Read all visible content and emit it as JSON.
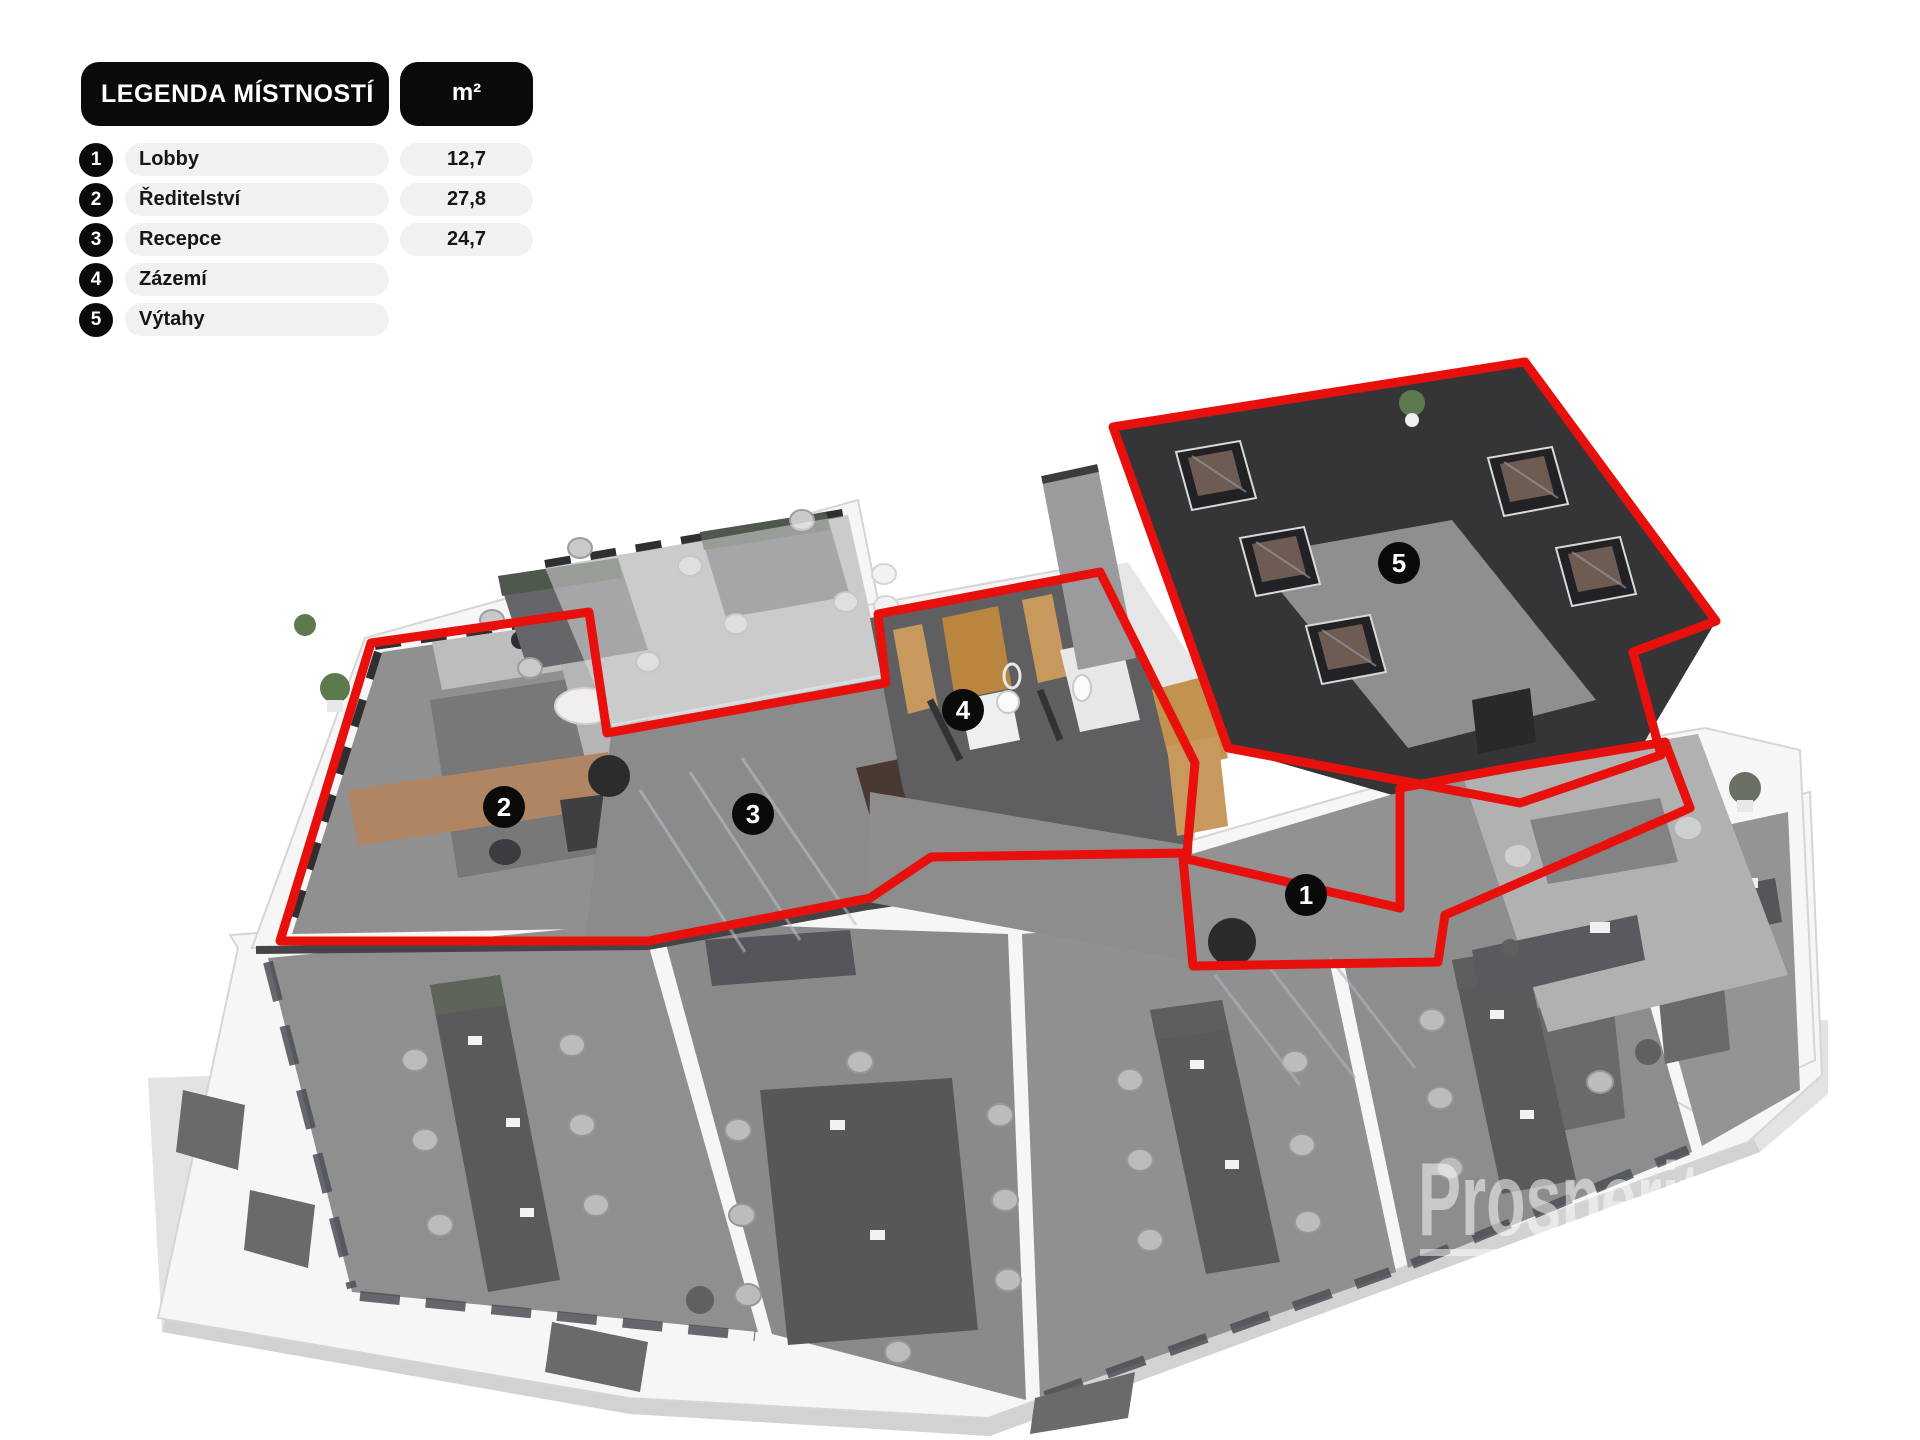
{
  "legend": {
    "title": "LEGENDA MÍSTNOSTÍ",
    "unit_header": "m²",
    "rows": [
      {
        "num": "1",
        "label": "Lobby",
        "area": "12,7"
      },
      {
        "num": "2",
        "label": "Ředitelství",
        "area": "27,8"
      },
      {
        "num": "3",
        "label": "Recepce",
        "area": "24,7"
      },
      {
        "num": "4",
        "label": "Zázemí",
        "area": ""
      },
      {
        "num": "5",
        "label": "Výtahy",
        "area": ""
      }
    ]
  },
  "floorplan": {
    "badges": [
      {
        "num": "1",
        "x": 1306,
        "y": 895
      },
      {
        "num": "2",
        "x": 504,
        "y": 807
      },
      {
        "num": "3",
        "x": 753,
        "y": 814
      },
      {
        "num": "4",
        "x": 963,
        "y": 710
      },
      {
        "num": "5",
        "x": 1399,
        "y": 563
      }
    ],
    "colors": {
      "highlight_outline": "#e8100c",
      "badge_background": "#0a0a0a",
      "badge_text": "#ffffff",
      "wall_dark": "#353537",
      "floor_gray": "#8e8e8e",
      "wood": "#c8995c"
    }
  },
  "watermark": {
    "text": "Prosperity F"
  }
}
